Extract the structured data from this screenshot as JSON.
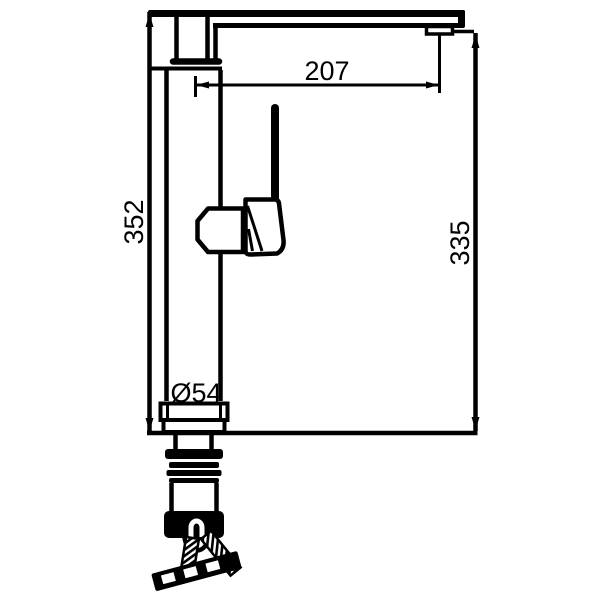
{
  "drawing": {
    "type": "technical-line-drawing",
    "subject": "single-handle kitchen faucet side elevation with mounting hardware",
    "labels": {
      "spout_reach": "207",
      "overall_height": "352",
      "spout_outlet_height": "335",
      "base_diameter": "Ø54"
    },
    "colors": {
      "line": "#000000",
      "background": "#ffffff"
    }
  }
}
